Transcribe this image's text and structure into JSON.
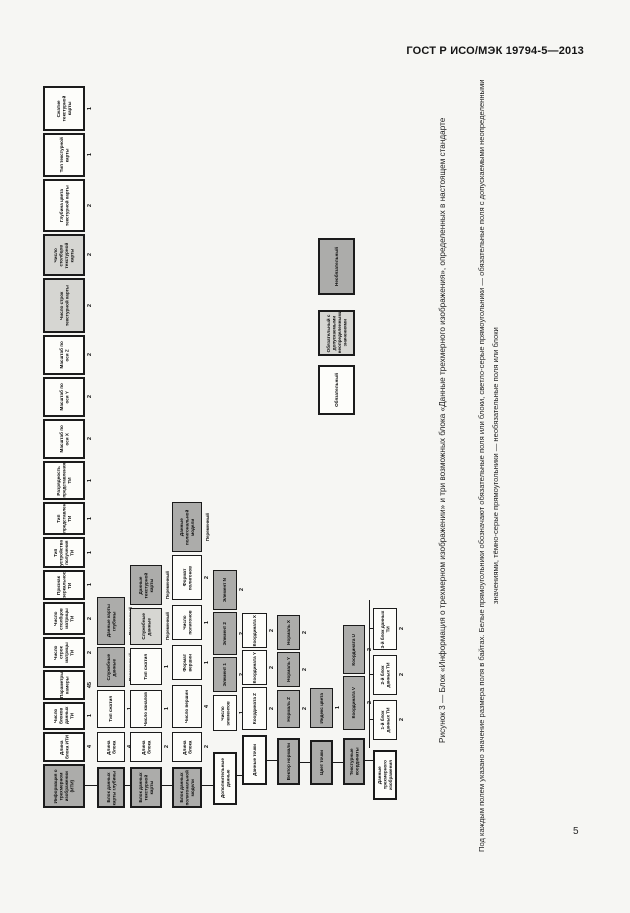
{
  "page": {
    "header": "ГОСТ Р ИСО/МЭК 19794-5—2013",
    "page_number": "5"
  },
  "figure": {
    "caption": "Рисунок 3 — Блок «Информация о трехмерном изображении» и три возможных блока «Данные трехмерного изображения», определенных в настоящем стандарте",
    "note": "Под каждым полем указано значение размера поля в байтах. Белые прямоугольники обозначают обязательные поля или блоки, светло-серые прямоугольники — обязательные поля с допускаемыми неопределенными значениями, тёмно-серые прямоугольники — необязательные поля или блоки"
  },
  "legend": [
    {
      "fill": "white",
      "label": "Обязательный"
    },
    {
      "fill": "light-gray",
      "label": "Обязательный с допускаемыми неопределенными значениями"
    },
    {
      "fill": "dark-gray",
      "label": "Необязательный"
    }
  ],
  "colors": {
    "page_background": "#f6f6f3",
    "box_white": "#fdfdfa",
    "box_light_gray": "#d6d6d2",
    "box_dark_gray": "#acacaa",
    "border": "#1b1b1b"
  },
  "diagram": {
    "orientation": "rotated-90-ccw",
    "boxes": [
      {
        "x": 43,
        "y": 86,
        "w": 42,
        "h": 45,
        "f": "W",
        "b": 2,
        "s": "1",
        "t": "Сжатие текстурной карты"
      },
      {
        "x": 43,
        "y": 133,
        "w": 42,
        "h": 44,
        "f": "W",
        "b": 2,
        "s": "1",
        "t": "Тип текстурной карты"
      },
      {
        "x": 43,
        "y": 179,
        "w": 42,
        "h": 53,
        "f": "W",
        "b": 2,
        "s": "2",
        "t": "Глубина цвета текстурной карты"
      },
      {
        "x": 43,
        "y": 234,
        "w": 42,
        "h": 42,
        "f": "LG",
        "b": 2,
        "s": "2",
        "t": "Число столбцов текстурной карты"
      },
      {
        "x": 43,
        "y": 278,
        "w": 42,
        "h": 55,
        "f": "LG",
        "b": 2,
        "s": "2",
        "t": "Число строк текстурной карты"
      },
      {
        "x": 43,
        "y": 335,
        "w": 42,
        "h": 40,
        "f": "W",
        "b": 2,
        "s": "2",
        "t": "Масштаб по оси Z"
      },
      {
        "x": 43,
        "y": 377,
        "w": 42,
        "h": 40,
        "f": "W",
        "b": 2,
        "s": "2",
        "t": "Масштаб по оси Y"
      },
      {
        "x": 43,
        "y": 419,
        "w": 42,
        "h": 40,
        "f": "W",
        "b": 2,
        "s": "2",
        "t": "Масштаб по оси X"
      },
      {
        "x": 43,
        "y": 461,
        "w": 42,
        "h": 39,
        "f": "W",
        "b": 2,
        "s": "1",
        "t": "Разрядность представления ТИ"
      },
      {
        "x": 43,
        "y": 502,
        "w": 42,
        "h": 33,
        "f": "W",
        "b": 2,
        "s": "1",
        "t": "Тип представления ТИ"
      },
      {
        "x": 43,
        "y": 537,
        "w": 42,
        "h": 31,
        "f": "W",
        "b": 2,
        "s": "1",
        "t": "Тип устройства получения ТИ"
      },
      {
        "x": 43,
        "y": 570,
        "w": 42,
        "h": 30,
        "f": "W",
        "b": 2,
        "s": "1",
        "t": "Признак зеркальности ТИ"
      },
      {
        "x": 43,
        "y": 602,
        "w": 42,
        "h": 33,
        "f": "W",
        "b": 2,
        "s": "2",
        "t": "Число столбцов матрицы ТИ"
      },
      {
        "x": 43,
        "y": 637,
        "w": 42,
        "h": 31,
        "f": "W",
        "b": 2,
        "s": "2",
        "t": "Число строк матрицы ТИ"
      },
      {
        "x": 43,
        "y": 670,
        "w": 42,
        "h": 30,
        "f": "W",
        "b": 2,
        "s": "45",
        "t": "Параметры камеры"
      },
      {
        "x": 43,
        "y": 702,
        "w": 42,
        "h": 28,
        "f": "W",
        "b": 2,
        "s": "1",
        "t": "Число блоков данных ТИ"
      },
      {
        "x": 43,
        "y": 732,
        "w": 42,
        "h": 30,
        "f": "W",
        "b": 2,
        "s": "4",
        "t": "Длина блока ИТИ"
      },
      {
        "x": 43,
        "y": 764,
        "w": 42,
        "h": 44,
        "f": "DG",
        "b": 2,
        "s": "",
        "t": "Информация о трехмерном изображении (ИТИ)"
      },
      {
        "x": 97,
        "y": 597,
        "w": 28,
        "h": 48,
        "f": "DG",
        "b": 1,
        "s": "Переменный",
        "t": "Данные карты глубины"
      },
      {
        "x": 97,
        "y": 647,
        "w": 28,
        "h": 40,
        "f": "DG",
        "b": 1,
        "s": "Переменный",
        "t": "Служебные данные"
      },
      {
        "x": 97,
        "y": 690,
        "w": 28,
        "h": 38,
        "f": "W",
        "b": 1,
        "s": "1",
        "t": "Тип сжатия"
      },
      {
        "x": 97,
        "y": 732,
        "w": 28,
        "h": 30,
        "f": "W",
        "b": 1,
        "s": "4",
        "t": "Длина блока"
      },
      {
        "x": 97,
        "y": 767,
        "w": 28,
        "h": 41,
        "f": "DG",
        "b": 2,
        "s": "",
        "t": "Блок данных карты глубины"
      },
      {
        "x": 130,
        "y": 565,
        "w": 32,
        "h": 40,
        "f": "DG",
        "b": 1,
        "s": "Переменный",
        "t": "Данные текстурной карты"
      },
      {
        "x": 130,
        "y": 608,
        "w": 32,
        "h": 37,
        "f": "LG",
        "b": 1,
        "s": "Переменный",
        "t": "Служебные данные"
      },
      {
        "x": 130,
        "y": 648,
        "w": 32,
        "h": 37,
        "f": "W",
        "b": 1,
        "s": "1",
        "t": "Тип сжатия"
      },
      {
        "x": 130,
        "y": 690,
        "w": 32,
        "h": 38,
        "f": "W",
        "b": 1,
        "s": "1",
        "t": "Число каналов"
      },
      {
        "x": 130,
        "y": 732,
        "w": 32,
        "h": 30,
        "f": "W",
        "b": 1,
        "s": "2",
        "t": "Длина блока"
      },
      {
        "x": 130,
        "y": 767,
        "w": 32,
        "h": 41,
        "f": "DG",
        "b": 2,
        "s": "",
        "t": "Блок данных текстурной карты"
      },
      {
        "x": 172,
        "y": 502,
        "w": 30,
        "h": 50,
        "f": "DG",
        "b": 1,
        "s": "Переменный",
        "t": "Данные полигональной модели"
      },
      {
        "x": 172,
        "y": 555,
        "w": 30,
        "h": 45,
        "f": "W",
        "b": 1,
        "s": "2",
        "t": "Формат полигонов"
      },
      {
        "x": 172,
        "y": 605,
        "w": 30,
        "h": 35,
        "f": "W",
        "b": 1,
        "s": "1",
        "t": "Число полигонов"
      },
      {
        "x": 172,
        "y": 645,
        "w": 30,
        "h": 35,
        "f": "W",
        "b": 1,
        "s": "1",
        "t": "Формат вершин"
      },
      {
        "x": 172,
        "y": 685,
        "w": 30,
        "h": 43,
        "f": "W",
        "b": 1,
        "s": "4",
        "t": "Число вершин"
      },
      {
        "x": 172,
        "y": 732,
        "w": 30,
        "h": 30,
        "f": "W",
        "b": 1,
        "s": "2",
        "t": "Длина блока"
      },
      {
        "x": 172,
        "y": 767,
        "w": 30,
        "h": 41,
        "f": "DG",
        "b": 2,
        "s": "",
        "t": "Блок данных полигональной модели"
      },
      {
        "x": 213,
        "y": 570,
        "w": 24,
        "h": 40,
        "f": "DG",
        "b": 1,
        "s": "2",
        "t": "Элемент N"
      },
      {
        "x": 213,
        "y": 612,
        "w": 24,
        "h": 43,
        "f": "DG",
        "b": 1,
        "s": "2",
        "t": "Элемент 2"
      },
      {
        "x": 213,
        "y": 657,
        "w": 24,
        "h": 35,
        "f": "DG",
        "b": 1,
        "s": "2",
        "t": "Элемент 1"
      },
      {
        "x": 213,
        "y": 695,
        "w": 24,
        "h": 36,
        "f": "W",
        "b": 1,
        "s": "1",
        "t": "Число элементов"
      },
      {
        "x": 213,
        "y": 752,
        "w": 24,
        "h": 53,
        "f": "W",
        "b": 2,
        "s": "",
        "t": "Дополнительные данные"
      },
      {
        "x": 242,
        "y": 613,
        "w": 25,
        "h": 35,
        "f": "W",
        "b": 1,
        "s": "2",
        "t": "Координата X"
      },
      {
        "x": 242,
        "y": 650,
        "w": 25,
        "h": 35,
        "f": "W",
        "b": 1,
        "s": "2",
        "t": "Координата Y"
      },
      {
        "x": 242,
        "y": 687,
        "w": 25,
        "h": 43,
        "f": "W",
        "b": 1,
        "s": "2",
        "t": "Координата Z"
      },
      {
        "x": 242,
        "y": 735,
        "w": 25,
        "h": 50,
        "f": "W",
        "b": 2,
        "s": "",
        "t": "Данные точки"
      },
      {
        "x": 277,
        "y": 615,
        "w": 23,
        "h": 35,
        "f": "DG",
        "b": 1,
        "s": "2",
        "t": "Нормаль X"
      },
      {
        "x": 277,
        "y": 652,
        "w": 23,
        "h": 35,
        "f": "DG",
        "b": 1,
        "s": "2",
        "t": "Нормаль Y"
      },
      {
        "x": 277,
        "y": 690,
        "w": 23,
        "h": 38,
        "f": "DG",
        "b": 1,
        "s": "2",
        "t": "Нормаль Z"
      },
      {
        "x": 277,
        "y": 738,
        "w": 23,
        "h": 47,
        "f": "DG",
        "b": 2,
        "s": "",
        "t": "Вектор нормали"
      },
      {
        "x": 310,
        "y": 688,
        "w": 23,
        "h": 40,
        "f": "DG",
        "b": 1,
        "s": "1",
        "t": "Индекс цвета"
      },
      {
        "x": 310,
        "y": 740,
        "w": 23,
        "h": 45,
        "f": "DG",
        "b": 2,
        "s": "",
        "t": "Цвет точки"
      },
      {
        "x": 343,
        "y": 625,
        "w": 22,
        "h": 49,
        "f": "DG",
        "b": 1,
        "s": "2",
        "t": "Координата U"
      },
      {
        "x": 343,
        "y": 676,
        "w": 22,
        "h": 54,
        "f": "DG",
        "b": 1,
        "s": "2",
        "t": "Координата V"
      },
      {
        "x": 343,
        "y": 738,
        "w": 22,
        "h": 47,
        "f": "DG",
        "b": 2,
        "s": "",
        "t": "Текстурные координаты"
      },
      {
        "x": 373,
        "y": 608,
        "w": 24,
        "h": 42,
        "f": "W",
        "b": 1,
        "s": "2",
        "t": "3-й блок данных ТИ"
      },
      {
        "x": 373,
        "y": 655,
        "w": 24,
        "h": 40,
        "f": "W",
        "b": 1,
        "s": "2",
        "t": "2-й блок данных ТИ"
      },
      {
        "x": 373,
        "y": 700,
        "w": 24,
        "h": 40,
        "f": "W",
        "b": 1,
        "s": "2",
        "t": "1-й блок данных ТИ"
      },
      {
        "x": 373,
        "y": 750,
        "w": 24,
        "h": 50,
        "f": "W",
        "b": 2,
        "s": "",
        "t": "Данные трехмерного изображения"
      },
      {
        "x": 318,
        "y": 365,
        "w": 37,
        "h": 50,
        "f": "W",
        "b": 2,
        "s": "",
        "t": "Обязательный"
      },
      {
        "x": 318,
        "y": 310,
        "w": 37,
        "h": 46,
        "f": "LG",
        "b": 2,
        "s": "",
        "t": "Обязательный с допускаемыми неопределенными значениями"
      },
      {
        "x": 318,
        "y": 238,
        "w": 37,
        "h": 57,
        "f": "DG",
        "b": 2,
        "s": "",
        "t": "Необязательный"
      }
    ],
    "connectors": [
      {
        "x": 369,
        "y": 600,
        "w": 1,
        "h": 148
      },
      {
        "x": 370,
        "y": 628,
        "w": 3,
        "h": 1
      },
      {
        "x": 370,
        "y": 674,
        "w": 3,
        "h": 1
      },
      {
        "x": 370,
        "y": 719,
        "w": 3,
        "h": 1
      },
      {
        "x": 365,
        "y": 760,
        "w": 8,
        "h": 1
      },
      {
        "x": 85,
        "y": 785,
        "w": 12,
        "h": 1
      },
      {
        "x": 125,
        "y": 785,
        "w": 5,
        "h": 1
      },
      {
        "x": 162,
        "y": 785,
        "w": 10,
        "h": 1
      },
      {
        "x": 202,
        "y": 785,
        "w": 11,
        "h": 1
      },
      {
        "x": 237,
        "y": 775,
        "w": 5,
        "h": 1
      },
      {
        "x": 267,
        "y": 760,
        "w": 10,
        "h": 1
      },
      {
        "x": 300,
        "y": 762,
        "w": 10,
        "h": 1
      },
      {
        "x": 333,
        "y": 762,
        "w": 10,
        "h": 1
      }
    ]
  }
}
